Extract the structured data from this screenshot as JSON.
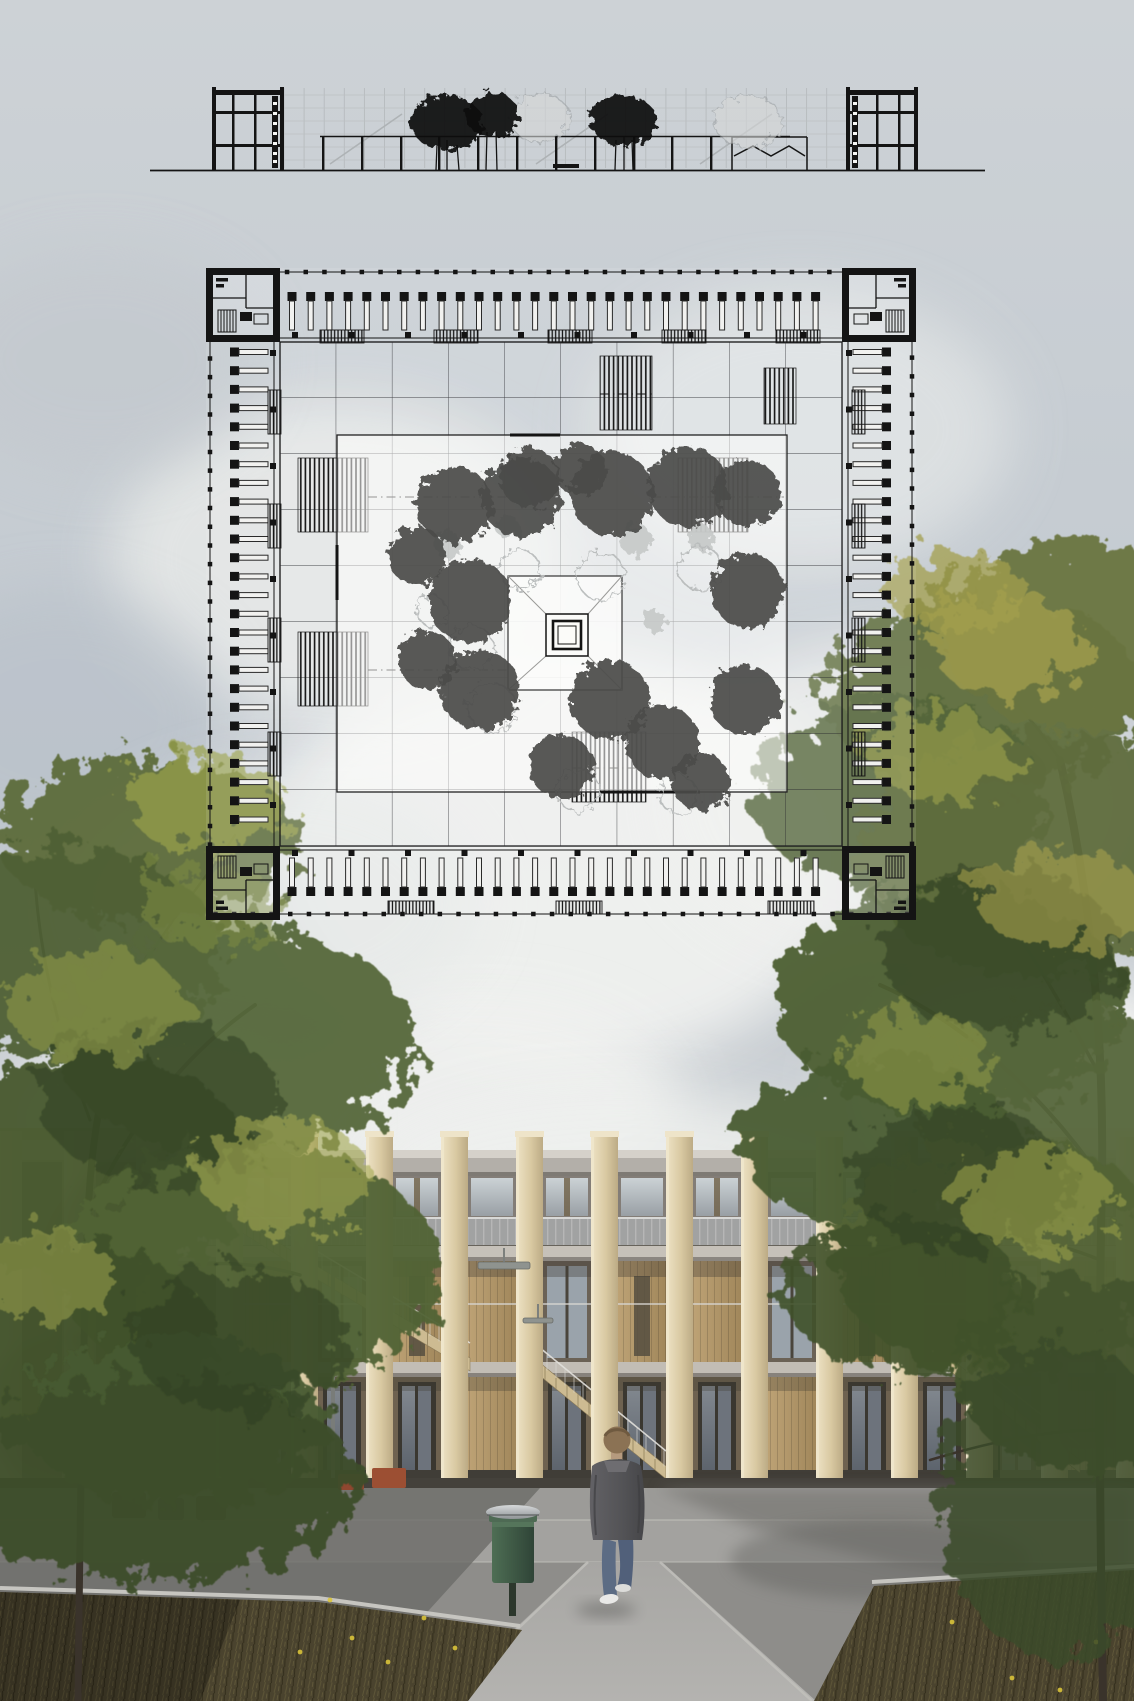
{
  "labels": {
    "page": "architectural presentation board",
    "sky": "overcast sky with cumulus clouds",
    "section": "building section and courtyard elevation drawing",
    "plan": "square courtyard building floor plan drawing",
    "courtyard": "courtyard planting with trees and central fountain",
    "render": "photorealistic rendering of timber colonnade building",
    "person": "man walking toward building",
    "bin": "green litter bin",
    "tree_left": "foreground oak tree left",
    "tree_right": "foreground oak tree right"
  },
  "palette": {
    "sky_top": "#cdd2d6",
    "sky_mid": "#c2c9d0",
    "sky_low": "#d0d3d5",
    "ink": "#141414",
    "gray_line": "#aeb2b4",
    "pillar": "#dccca5",
    "pillar_light": "#f0e6c9",
    "pillar_shade": "#bcab85",
    "slab": "#b3afa9",
    "slab_light": "#d5d1ca",
    "timber": "#b2986c",
    "timber_dark": "#6b6256",
    "ground_timber": "#6e6250",
    "glass": "#a3abb2",
    "plinth": "#403d37",
    "pavement": "#8e8d8a",
    "walkway": "#a3a29f",
    "path": "#aaa9a6",
    "curb": "#c6c5c0",
    "shadow": "#6c6b68",
    "grass": "#4a432e",
    "grass_light": "#675f3d",
    "flower": "#d9c33a",
    "foliage": "#57683a",
    "foliage_yellow": "#a8a24e",
    "trunk": "#3a332b",
    "jacket": "#57575a",
    "jeans": "#5c6c84",
    "hair": "#8b7254",
    "shoe": "#e9e9e7",
    "bin_green": "#3f5a44",
    "bin_cap": "#b9bcbe",
    "planter": "#9c4f33"
  },
  "sky": {
    "clouds": [
      [
        560,
        860,
        300,
        210,
        "#f2f3f1",
        0.9
      ],
      [
        340,
        560,
        230,
        160,
        "#e9ebe9",
        0.8
      ],
      [
        800,
        430,
        210,
        140,
        "#e4e7e7",
        0.7
      ],
      [
        1030,
        1090,
        190,
        120,
        "#f6f6f4",
        0.95
      ],
      [
        480,
        1110,
        200,
        110,
        "#f1f2f0",
        0.9
      ],
      [
        170,
        1120,
        170,
        100,
        "#eceeec",
        0.8
      ],
      [
        60,
        720,
        170,
        130,
        "#b7bfc8",
        0.55
      ],
      [
        100,
        360,
        160,
        110,
        "#c3c8cd",
        0.6
      ],
      [
        900,
        800,
        240,
        160,
        "#eff0ee",
        0.8
      ],
      [
        620,
        1180,
        260,
        90,
        "#eef0ee",
        0.85
      ],
      [
        280,
        900,
        200,
        130,
        "#e6e9e8",
        0.7
      ]
    ]
  },
  "section": {
    "ground": [
      150,
      170.5,
      985
    ],
    "grid_cols": {
      "x0": 284,
      "x1": 846,
      "step": 20.1,
      "y0": 88,
      "y1": 168
    },
    "grid_rows": [
      95,
      108,
      121,
      134,
      147,
      160
    ],
    "diagonals": [
      [
        330,
        164,
        402,
        114
      ],
      [
        536,
        164,
        608,
        114
      ],
      [
        700,
        164,
        772,
        114
      ]
    ],
    "colonnade": {
      "y": 136.5,
      "x0": 320,
      "x1": 790,
      "xs": [
        322,
        361,
        400,
        438,
        477,
        516,
        555,
        594,
        633,
        671,
        710
      ]
    },
    "trees_dark": [
      [
        447,
        123,
        36,
        27
      ],
      [
        492,
        115,
        27,
        22
      ],
      [
        623,
        120,
        33,
        25
      ]
    ],
    "trunks": [
      [
        437,
        145,
        436,
        170
      ],
      [
        447,
        140,
        447,
        170
      ],
      [
        457,
        145,
        459,
        170
      ],
      [
        487,
        132,
        486,
        170
      ],
      [
        496,
        132,
        497,
        170
      ],
      [
        616,
        140,
        615,
        170
      ],
      [
        624,
        136,
        624,
        170
      ],
      [
        632,
        140,
        633,
        170
      ]
    ],
    "trees_gray": [
      [
        540,
        118,
        30,
        24
      ],
      [
        748,
        121,
        34,
        26
      ]
    ]
  },
  "plan": {
    "bounds": {
      "x0": 206,
      "y0": 268,
      "x1": 916,
      "y1": 920
    },
    "rung_step": 18.7,
    "rungs": {
      "top": {
        "c": 311,
        "a0": 292,
        "a1": 830,
        "rot": 0,
        "axis": "x"
      },
      "bottom": {
        "c": 877,
        "a0": 292,
        "a1": 830,
        "rot": 180,
        "axis": "x"
      },
      "left": {
        "c": 249,
        "a0": 352,
        "a1": 838,
        "rot": -90,
        "axis": "y"
      },
      "right": {
        "c": 872,
        "a0": 352,
        "a1": 838,
        "rot": 90,
        "axis": "y"
      }
    },
    "combs": {
      "top": {
        "xs": [
          320,
          434,
          548,
          662,
          776
        ],
        "y": 330
      },
      "bottom": {
        "xs": [
          388,
          556,
          768
        ],
        "y": 901
      },
      "left": {
        "ys": [
          390,
          504,
          618,
          732
        ],
        "x": 268
      },
      "right": {
        "ys": [
          390,
          504,
          618,
          732
        ],
        "x": 852
      }
    },
    "hatches": [
      [
        298,
        458,
        70,
        74
      ],
      [
        678,
        458,
        70,
        74
      ],
      [
        298,
        632,
        70,
        74
      ],
      [
        572,
        732,
        74,
        70
      ],
      [
        600,
        356,
        52,
        74
      ],
      [
        764,
        368,
        32,
        56
      ]
    ],
    "dashdots": [
      [
        368,
        497,
        508,
        497
      ],
      [
        368,
        670,
        508,
        670
      ],
      [
        652,
        497,
        784,
        497
      ],
      [
        600,
        394,
        652,
        394
      ],
      [
        572,
        768,
        646,
        768
      ]
    ],
    "courtyard": {
      "x": 337,
      "y": 435,
      "w": 450,
      "h": 357,
      "trees_dark": [
        [
          455,
          505,
          38
        ],
        [
          417,
          556,
          29
        ],
        [
          521,
          497,
          40
        ],
        [
          612,
          494,
          42
        ],
        [
          688,
          487,
          40
        ],
        [
          747,
          493,
          33
        ],
        [
          470,
          601,
          42
        ],
        [
          748,
          591,
          37
        ],
        [
          480,
          690,
          40
        ],
        [
          427,
          660,
          29
        ],
        [
          610,
          700,
          40
        ],
        [
          662,
          742,
          37
        ],
        [
          561,
          766,
          32
        ],
        [
          745,
          700,
          35
        ],
        [
          700,
          781,
          29
        ],
        [
          530,
          478,
          30
        ],
        [
          580,
          470,
          26
        ]
      ],
      "trees_light": [
        [
          520,
          570,
          20
        ],
        [
          601,
          576,
          24
        ],
        [
          700,
          568,
          22
        ],
        [
          472,
          648,
          22
        ],
        [
          492,
          708,
          24
        ],
        [
          578,
          791,
          21
        ],
        [
          678,
          794,
          19
        ],
        [
          432,
          611,
          15
        ]
      ],
      "blobs": [
        [
          448,
          545,
          14
        ],
        [
          636,
          540,
          16
        ],
        [
          701,
          538,
          13
        ],
        [
          655,
          621,
          11
        ],
        [
          508,
          527,
          12
        ]
      ]
    },
    "plaza": {
      "x": 508,
      "y": 576,
      "s": 114,
      "f1": {
        "x": 546,
        "y": 614,
        "s": 42
      },
      "f2": {
        "x": 553,
        "y": 621,
        "s": 28
      },
      "f3": {
        "x": 558,
        "y": 626,
        "s": 18
      }
    }
  },
  "building": {
    "pillars": {
      "xs": [
        216,
        291,
        366,
        441,
        516,
        591,
        666,
        741,
        816,
        891,
        966,
        1041,
        1116
      ],
      "w": 27,
      "top": 1131,
      "bottom": 1490
    },
    "wing_pillars": [
      [
        -8,
        1131,
        30,
        359
      ],
      [
        64,
        1131,
        30,
        359
      ],
      [
        136,
        1131,
        30,
        359
      ]
    ],
    "stairs": [
      [
        300,
        1256,
        470,
        1358
      ],
      [
        220,
        1206,
        300,
        1256
      ],
      [
        534,
        1358,
        666,
        1466
      ],
      [
        950,
        1358,
        1080,
        1460
      ]
    ],
    "lamps": [
      [
        478,
        1262,
        52,
        7
      ],
      [
        523,
        1318,
        30,
        5
      ]
    ],
    "poles": [
      [
        331,
        1268,
        4,
        220
      ],
      [
        184,
        1408,
        3,
        112
      ]
    ]
  },
  "ground": {
    "flowers": [
      [
        352,
        1638
      ],
      [
        388,
        1662
      ],
      [
        424,
        1618
      ],
      [
        330,
        1600
      ],
      [
        300,
        1652
      ],
      [
        455,
        1648
      ],
      [
        1012,
        1678
      ],
      [
        1096,
        1642
      ],
      [
        952,
        1622
      ],
      [
        1060,
        1690
      ]
    ]
  },
  "trees": {
    "left": {
      "canopies": [
        [
          150,
          840,
          150,
          85,
          "#5d6c3a",
          0.95
        ],
        [
          60,
          950,
          160,
          105,
          "#4f6134",
          0.95
        ],
        [
          235,
          1040,
          180,
          115,
          "#57683a",
          0.95
        ],
        [
          90,
          1170,
          165,
          115,
          "#47592f",
          0.95
        ],
        [
          250,
          1270,
          190,
          125,
          "#516336",
          0.95
        ],
        [
          60,
          1345,
          155,
          105,
          "#3f512b",
          0.95
        ],
        [
          175,
          1420,
          150,
          85,
          "#465a31",
          0.95
        ],
        [
          150,
          1480,
          210,
          100,
          "#3c4e2a",
          0.95
        ]
      ],
      "accents": [
        [
          205,
          800,
          80,
          50,
          "#9aa24c",
          0.7
        ],
        [
          95,
          1005,
          90,
          55,
          "#8b9547",
          0.65
        ],
        [
          285,
          1175,
          85,
          55,
          "#a3a851",
          0.6
        ],
        [
          45,
          1275,
          70,
          45,
          "#959c4b",
          0.6
        ],
        [
          210,
          905,
          70,
          40,
          "#7b8a42",
          0.6
        ]
      ],
      "shadows": [
        [
          160,
          1100,
          120,
          80
        ],
        [
          240,
          1340,
          110,
          70
        ]
      ],
      "branches": [
        {
          "d": "M78,1701 C80,1520 82,1380 88,1215 C92,1120 110,1030 150,955",
          "w": 7
        },
        {
          "d": "M88,1215 C130,1120 190,1050 255,1005",
          "w": 4
        },
        {
          "d": "M86,1300 C150,1260 230,1255 300,1275",
          "w": 3.5
        },
        {
          "d": "M84,1420 C130,1430 190,1450 240,1470",
          "w": 3
        },
        {
          "d": "M90,1120 C60,1040 40,960 35,880",
          "w": 3
        },
        {
          "d": "M150,955 C185,900 220,860 235,835",
          "w": 2.5
        }
      ]
    },
    "right": {
      "canopies": [
        [
          985,
          695,
          160,
          100,
          "#5f6d3c",
          0.95
        ],
        [
          1080,
          635,
          140,
          95,
          "#6a7540",
          0.95
        ],
        [
          900,
          795,
          150,
          95,
          "#55663a",
          0.95
        ],
        [
          1045,
          855,
          185,
          120,
          "#5e6c3c",
          0.95
        ],
        [
          950,
          1000,
          175,
          115,
          "#4e5f33",
          0.95
        ],
        [
          1075,
          1115,
          150,
          105,
          "#57663a",
          0.95
        ],
        [
          880,
          1145,
          140,
          85,
          "#4a5b31",
          0.95
        ],
        [
          1000,
          1255,
          170,
          115,
          "#526336",
          0.95
        ],
        [
          1090,
          1375,
          135,
          95,
          "#44552d",
          0.95
        ],
        [
          905,
          1295,
          120,
          75,
          "#3f512b",
          0.9
        ],
        [
          1060,
          1500,
          120,
          160,
          "#3a4c29",
          0.85
        ]
      ],
      "accents": [
        [
          1010,
          645,
          80,
          50,
          "#aaa44f",
          0.7
        ],
        [
          940,
          755,
          75,
          45,
          "#9aa04c",
          0.65
        ],
        [
          1062,
          900,
          85,
          50,
          "#a8a24e",
          0.6
        ],
        [
          918,
          1058,
          75,
          45,
          "#8f9847",
          0.6
        ],
        [
          1032,
          1198,
          80,
          50,
          "#99a04a",
          0.6
        ],
        [
          955,
          590,
          70,
          40,
          "#a39f4d",
          0.75
        ]
      ],
      "shadows": [
        [
          1000,
          950,
          120,
          80
        ],
        [
          960,
          1180,
          110,
          70
        ]
      ],
      "branches": [
        {
          "d": "M1103,1701 C1100,1520 1098,1360 1102,1180 C1104,1040 1092,900 1060,760",
          "w": 8
        },
        {
          "d": "M1102,1180 C1040,1090 960,1020 880,985",
          "w": 4
        },
        {
          "d": "M1100,1260 C1030,1230 950,1230 870,1255",
          "w": 3.5
        },
        {
          "d": "M1102,1080 C1060,1000 1020,930 975,880",
          "w": 3.5
        },
        {
          "d": "M1060,760 C1020,700 980,665 945,650",
          "w": 3
        },
        {
          "d": "M1100,1430 C1040,1430 980,1445 930,1460",
          "w": 2.5
        }
      ]
    }
  }
}
